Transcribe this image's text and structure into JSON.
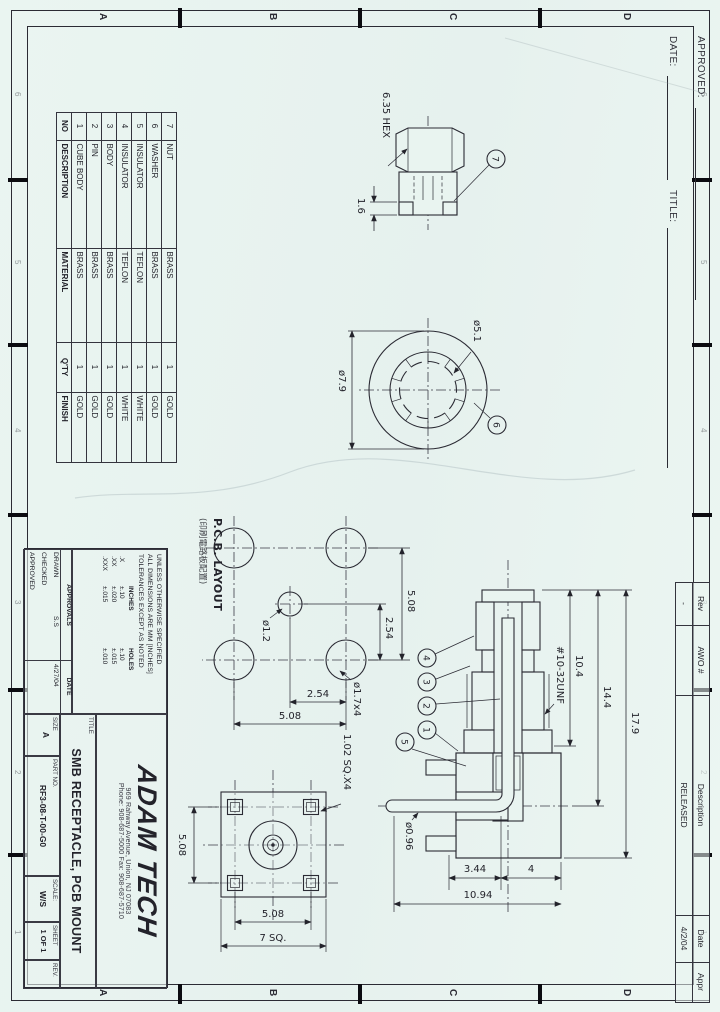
{
  "frame": {
    "zone_letters": [
      "A",
      "B",
      "C",
      "D"
    ],
    "zone_numbers": [
      "1",
      "2",
      "3",
      "4",
      "5",
      "6"
    ]
  },
  "signature_area": {
    "approved_label": "APPROVED:",
    "date_label": "DATE:",
    "title_label": "TITLE:"
  },
  "revision_table": {
    "headers": {
      "rev": "Rev",
      "awo": "AWO #",
      "description": "Description",
      "date": "Date",
      "appr": "Appr"
    },
    "entry": {
      "rev": "-",
      "awo": "",
      "description": "RELEASED",
      "date": "4/2/04",
      "appr": ""
    }
  },
  "parts_table": {
    "headers": [
      "NO",
      "DESCRIPTION",
      "MATERIAL",
      "Q'TY",
      "FINISH"
    ],
    "rows": [
      [
        "7",
        "NUT",
        "BRASS",
        "1",
        "GOLD"
      ],
      [
        "6",
        "WASHER",
        "BRASS",
        "1",
        "GOLD"
      ],
      [
        "5",
        "INSULATOR",
        "TEFLON",
        "1",
        "WHITE"
      ],
      [
        "4",
        "INSULATOR",
        "TEFLON",
        "1",
        "WHITE"
      ],
      [
        "3",
        "BODY",
        "BRASS",
        "1",
        "GOLD"
      ],
      [
        "2",
        "PIN",
        "BRASS",
        "1",
        "GOLD"
      ],
      [
        "1",
        "CUBE BODY",
        "BRASS",
        "1",
        "GOLD"
      ]
    ]
  },
  "views": {
    "nut": {
      "balloon": "7",
      "across_flats": "6.35 HEX",
      "thickness": "1.6"
    },
    "washer": {
      "balloon": "6",
      "outer_dia": "ø7.9",
      "inner_dia": "ø5.1"
    },
    "pcb": {
      "title": "P.C.B. LAYOUT",
      "subtitle": "(印刷電路板配置)",
      "pitch_x": "2.54",
      "span_x": "5.08",
      "pitch_y": "2.54",
      "span_y": "5.08",
      "center_hole": "ø1.2",
      "corner_hole": "ø1.7x4"
    },
    "section": {
      "thread_spec": "#10-32UNF",
      "len_front": "10.4",
      "len_mid": "14.4",
      "len_total": "17.9",
      "h_top": "4",
      "h_mid": "3.44",
      "h_total": "10.94",
      "pin_dia": "ø0.96",
      "balloon_1": "1",
      "balloon_2": "2",
      "balloon_3": "3",
      "balloon_4": "4",
      "balloon_5": "5"
    },
    "front": {
      "post_size": "1.02 SQ.X4",
      "hole_pitch_h": "5.08",
      "hole_pitch_v": "5.08",
      "body_size": "7 SQ."
    }
  },
  "title_block": {
    "notes": [
      "UNLESS OTHERWISE SPECIFIED",
      "ALL DIMENSIONS ARE MM [INCHES]",
      "TOLERANCES EXCEPT AS NOTED"
    ],
    "tol_headers": [
      "",
      "INCHES",
      "HOLES"
    ],
    "tol_rows": [
      [
        ".X",
        "±.10",
        "±.10"
      ],
      [
        ".XX",
        "±.020",
        "±.015"
      ],
      [
        ".XXX",
        "±.015",
        "±.010"
      ]
    ],
    "approvals_label": "APPROVALS",
    "date_col_label": "DATE",
    "drawn_label": "DRAWN",
    "drawn_by": "S.S",
    "drawn_date": "4/27/04",
    "checked_label": "CHECKED",
    "approved_label": "APPROVED",
    "company": "ADAM TECH",
    "address": "969 Rahway Avenue, Union, NJ 07083",
    "phone_fax": "Phone: 908-687-5000    Fax: 908-687-5710",
    "title_label": "TITLE",
    "title": "SMB RECEPTACLE, PCB MOUNT",
    "size_label": "SIZE",
    "size_value": "A",
    "part_no_label": "PART NO.",
    "part_no": "RF3-08-T-00-G0",
    "scale_label": "SCALE:",
    "scale_value": "W/S",
    "sheet_label": "SHEET",
    "sheet_value": "1 OF 1",
    "rev_label": "REV."
  }
}
